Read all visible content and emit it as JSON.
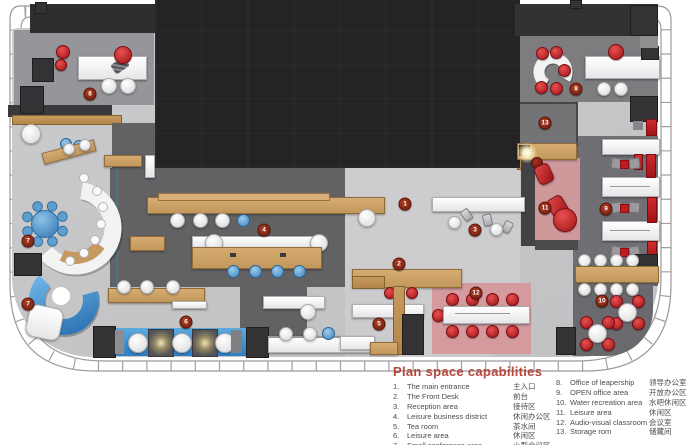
{
  "legend": {
    "title": "Plan space capabilities",
    "col1": [
      {
        "num": "1.",
        "en": "The main entrance",
        "zh": "主入口"
      },
      {
        "num": "2.",
        "en": "The Front Desk",
        "zh": "前台"
      },
      {
        "num": "3.",
        "en": "Reception area",
        "zh": "接待区"
      },
      {
        "num": "4.",
        "en": "Leisure business district",
        "zh": "休闲办公区"
      },
      {
        "num": "5.",
        "en": "Tea room",
        "zh": "茶水间"
      },
      {
        "num": "6.",
        "en": "Leisure area",
        "zh": "休闲区"
      },
      {
        "num": "7.",
        "en": "Small conference area",
        "zh": "小型会议区"
      }
    ],
    "col2": [
      {
        "num": "8.",
        "en": "Office of leapership",
        "zh": "领导办公室"
      },
      {
        "num": "9.",
        "en": "OPEN office area",
        "zh": "开放办公区"
      },
      {
        "num": "10.",
        "en": "Water recreation area",
        "zh": "水吧休闲区"
      },
      {
        "num": "11.",
        "en": "Leisure area",
        "zh": "休闲区"
      },
      {
        "num": "12.",
        "en": "Audio-visual classroom",
        "zh": "会议室"
      },
      {
        "num": "13.",
        "en": "Storage rom",
        "zh": "储藏间"
      }
    ]
  },
  "markers": [
    {
      "n": "1",
      "x": 405,
      "y": 204
    },
    {
      "n": "2",
      "x": 399,
      "y": 264
    },
    {
      "n": "3",
      "x": 475,
      "y": 230
    },
    {
      "n": "4",
      "x": 264,
      "y": 230
    },
    {
      "n": "5",
      "x": 379,
      "y": 324
    },
    {
      "n": "6",
      "x": 186,
      "y": 322
    },
    {
      "n": "7",
      "x": 28,
      "y": 241
    },
    {
      "n": "7",
      "x": 28,
      "y": 304
    },
    {
      "n": "8",
      "x": 90,
      "y": 94
    },
    {
      "n": "8",
      "x": 576,
      "y": 89
    },
    {
      "n": "9",
      "x": 606,
      "y": 209
    },
    {
      "n": "10",
      "x": 602,
      "y": 301
    },
    {
      "n": "11",
      "x": 545,
      "y": 208
    },
    {
      "n": "12",
      "x": 476,
      "y": 293
    },
    {
      "n": "13",
      "x": 545,
      "y": 123
    }
  ],
  "colors": {
    "legend_title": "#b5473d",
    "marker_red": "#7c2418",
    "accent_red": "#c0191f",
    "wood": "#c99c63",
    "pool_blue": "#3f8fcc",
    "room_pink": "#d49a9d",
    "roof_dark": "#242427"
  }
}
